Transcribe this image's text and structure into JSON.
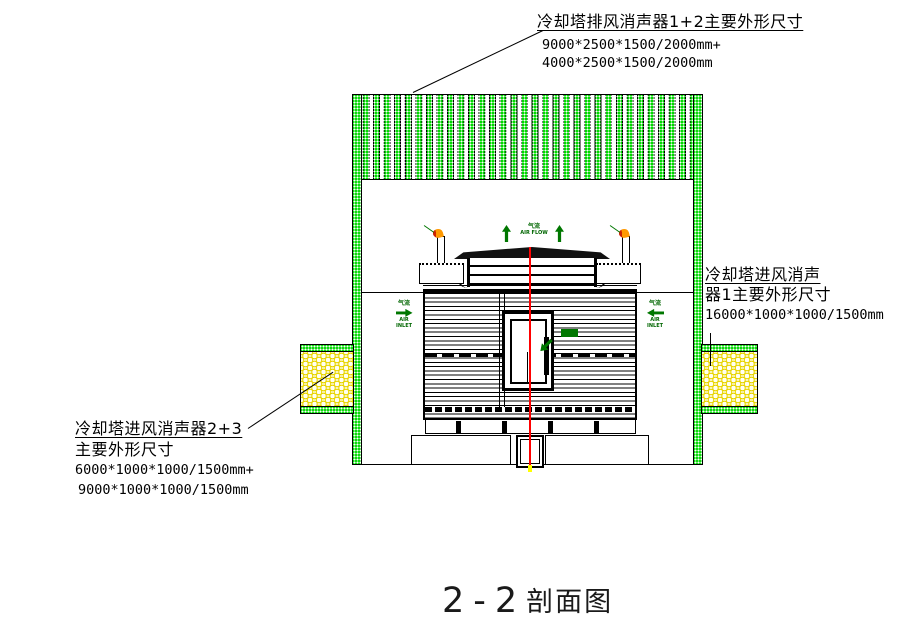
{
  "drawing": {
    "title": {
      "number": "2-2",
      "suffix": "剖面图"
    },
    "annotations": {
      "exhaust": {
        "title": "冷却塔排风消声器1+2主要外形尺寸",
        "dim1": "9000*2500*1500/2000mm+",
        "dim2": "4000*2500*1500/2000mm"
      },
      "intake1": {
        "title_line1": "冷却塔进风消声",
        "title_line2": "器1主要外形尺寸",
        "dim1": "16000*1000*1000/1500mm"
      },
      "intake23": {
        "title_line1": "冷却塔进风消声器2+3",
        "title_line2": "主要外形尺寸",
        "dim1": "6000*1000*1000/1500mm+",
        "dim2": "9000*1000*1000/1500mm"
      }
    },
    "labels": {
      "air_flow_cn": "气流",
      "air_flow_en": "AIR FLOW",
      "air_inlet_cn": "气流",
      "air_inlet_en1": "AIR",
      "air_inlet_en2": "INLET"
    },
    "colors": {
      "hatch_green": "#00d800",
      "hatch_yellow": "#e8d400",
      "centerline_red": "#ff0000",
      "label_green": "#006600",
      "end_mark_yellow": "#ffff00"
    }
  }
}
